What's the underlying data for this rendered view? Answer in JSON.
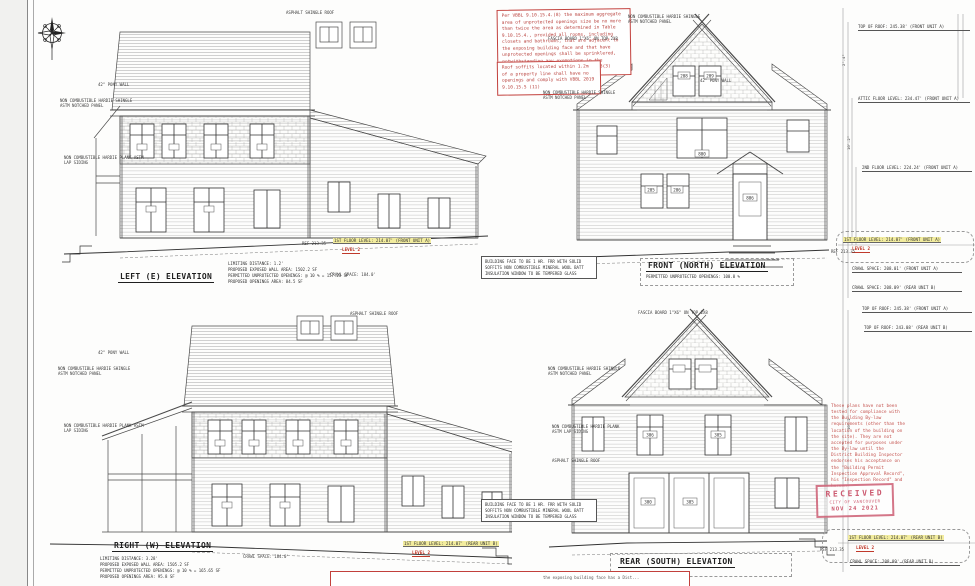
{
  "colors": {
    "annotation_red": "#c0392b",
    "highlight_yellow": "#f2ec9e",
    "stamp_pink": "#c64860",
    "line": "#444444"
  },
  "notes": {
    "vbbl": "Per VBBL 9.10.15.4.(8) the maximum aggregate area of unprotected openings size be no more than twice the area as determined in Table 9.10.15.4., provided all rooms, including closets and bathrooms, that are adjacent to the exposing building face and that have unprotected openings shall be sprinklered, notwithstanding any exemptions in the sprinkler standards referenced in A/3(3)",
    "soffit": "Roof soffits located within 1.2m of a property line shall have no openings and comply with VBBL 2019 9.10.15.5 (11)",
    "fire": "BUILDING FACE TO BE 1 HR. FRR WITH SOLID SOFFITS NON COMBUSTIBLE MINERAL WOOL BATT INSULATION WINDOW TO BE TEMPERED GLASS",
    "bottom_partial": "the exposing building face has a Dist..."
  },
  "materials": {
    "asphalt_roof": "ASPHALT SHINGLE ROOF",
    "shingle_panel": "NON COMBUSTIBLE HARDIE SHINGLE ASTM NOTCHED PANEL",
    "lap_siding": "NON COMBUSTIBLE HARDIE PLANK ASTM LAP SIDING",
    "pony_wall": "42\" PONY WALL",
    "fascia_board": "FASCIA BOARD 1\"X6\" ON TOP 2X8"
  },
  "elevations": {
    "left": {
      "title": "LEFT (E) ELEVATION",
      "stats": [
        "LIMITING DISTANCE: 1.2'",
        "PROPOSED EXPOSED WALL AREA: 1502.2 SF",
        "PERMITTED UNPROTECTED OPENINGS: @ 10 % = 157.23 SF",
        "PROPOSED OPENINGS AREA: 84.5 SF"
      ]
    },
    "front": {
      "title": "FRONT (NORTH) ELEVATION",
      "sub": "PERMITTED UNPROTECTED OPENINGS: 100.0 %"
    },
    "right": {
      "title": "RIGHT (W) ELEVATION",
      "stats": [
        "LIMITING DISTANCE: 3.28'",
        "PROPOSED EXPOSED WALL AREA: 1505.2 SF",
        "PERMITTED UNPROTECTED OPENINGS: @ 10 % = 165.65 SF",
        "PROPOSED OPENINGS AREA: 95.8 SF"
      ]
    },
    "rear": {
      "title": "REAR (SOUTH) ELEVATION"
    }
  },
  "levels": {
    "top_roof_front": "TOP OF ROOF: 245.38' (FRONT UNIT A)",
    "attic_floor": "ATTIC FLOOR LEVEL: 234.47' (FRONT UNIT A)",
    "second_floor": "2ND FLOOR LEVEL: 224.24' (FRONT UNIT A)",
    "first_floor_front": "1ST FLOOR LEVEL: 214.07' (FRONT UNIT A)",
    "first_floor_rear": "1ST FLOOR LEVEL: 214.07' (REAR UNIT B)",
    "crawl_front": "CRAWL SPACE: 208.01' (FRONT UNIT A)",
    "crawl_rear": "CRAWL SPACE: 208.09' (REAR UNIT B)",
    "top_roof_rear": "TOP OF ROOF: 243.08' (REAR UNIT B)",
    "level2": "LEVEL 2",
    "ref": "REF 213.35",
    "crawl_184": "CRAWL SPACE: 184.0'"
  },
  "dims": {
    "d1": "10'-2\"",
    "d2": "2'-4\""
  },
  "window_tags": {
    "front": [
      "208",
      "209",
      "800",
      "806",
      "205",
      "206"
    ],
    "rear": [
      "306",
      "305",
      "300",
      "305"
    ]
  },
  "stamp": {
    "received": "RECEIVED",
    "city": "CITY OF VANCOUVER",
    "date": "NOV 24 2021"
  },
  "disclaimer": "These plans have not been tested for compliance with the Building By-law requirements (other than the location of the building on the site). They are not accepted for purposes under the By-law until the District Building Inspector endorses his acceptance on the \"Building Permit Inspection Approval Record\", his \"Inspection Record\" and hereon."
}
